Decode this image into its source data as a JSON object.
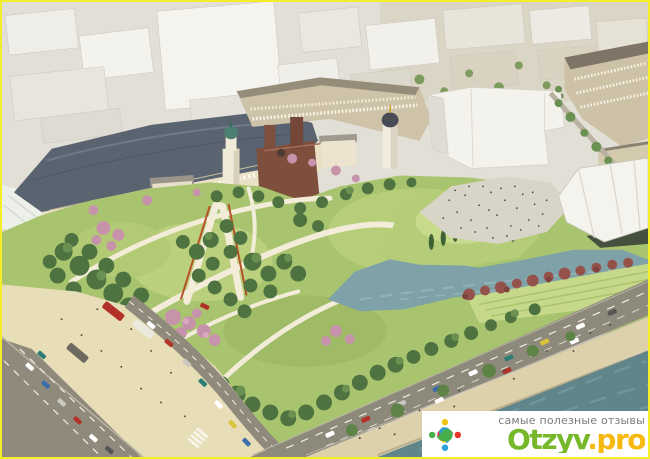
{
  "frame": {
    "border_color": "#f4ee2a"
  },
  "watermark": {
    "tagline": "самые полезные отзывы",
    "brand": "Otzyv.pro",
    "brand_primary": "Otzyv",
    "brand_suffix": ".pro",
    "brand_primary_color": "#76b82a",
    "brand_suffix_color": "#f7b910",
    "tagline_color": "#7b7b7b",
    "background": "#ffffff",
    "logo_icon": "people-circle-logo",
    "logo_colors": [
      "#f0c318",
      "#e5322b",
      "#2b9fd8",
      "#47ae4b"
    ]
  },
  "scene": {
    "subject": "aerial-park-render",
    "palette": {
      "city_white": "#f3f2ed",
      "building_tan": "#cdc2a8",
      "arcade_roof": "#5a6370",
      "facade_cream": "#eae0c5",
      "church_brown": "#7e4f3d",
      "dome_green": "#4e8072",
      "park_green": "#a9c46f",
      "tree_dark": "#4e7340",
      "blossom_pink": "#c793ab",
      "shrub_maroon": "#95524b",
      "path_cream": "#f2ecd8",
      "pond_water": "#7fa1a8",
      "river_water": "#60858a",
      "road_gray": "#8f8a7c",
      "sand_beige": "#ddd1ab",
      "plaza_beige": "#e7ddb6"
    }
  }
}
